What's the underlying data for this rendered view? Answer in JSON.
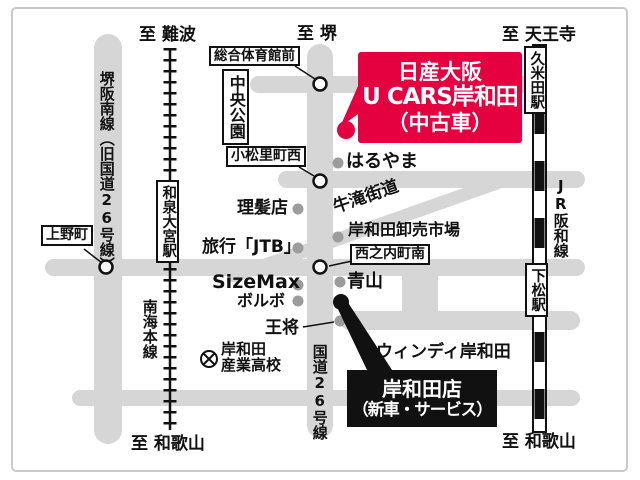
{
  "map": {
    "dealer_box": {
      "line1": "日産大阪",
      "line2": "U CARS岸和田",
      "line3": "（中古車）"
    },
    "branch_box": {
      "line1": "岸和田店",
      "line2": "（新車・サービス）"
    },
    "directions": {
      "namba": "至 難波",
      "sakai": "至 堺",
      "tennoji": "至 天王寺",
      "wakayama_left": "至 和歌山",
      "wakayama_right": "至 和歌山"
    },
    "roads": {
      "sakai_hannan": "堺阪南線（旧国道26号線）",
      "route26": "国道26号線",
      "ushitaki": "牛滝街道"
    },
    "railways": {
      "nankai": "南海本線",
      "jr_hanwa": "JR阪和線"
    },
    "stations": {
      "izumi_omiya": "和泉大宮駅",
      "kumeda": "久米田駅",
      "shimomatsu": "下松駅"
    },
    "intersections": {
      "sogo_taiikukan": "総合体育館前",
      "komatsuri": "小松里町西",
      "ueno": "上野町",
      "nishinouchi": "西之内町南"
    },
    "landmarks": {
      "chuo_koen": "中央公園",
      "haruyama": "はるやま",
      "rihatsu": "理髪店",
      "jtb": "旅行「JTB」",
      "sizemax": "SizeMax",
      "volvo": "ボルボ",
      "osho": "王将",
      "aoyama": "青山",
      "oroshiuri": "岸和田卸売市場",
      "windy": "ウィンディ岸和田",
      "school_line1": "岸和田",
      "school_line2": "産業高校"
    },
    "colors": {
      "accent_red": "#e50040",
      "road_gray": "#d6d6d6",
      "box_black": "#111111"
    }
  }
}
